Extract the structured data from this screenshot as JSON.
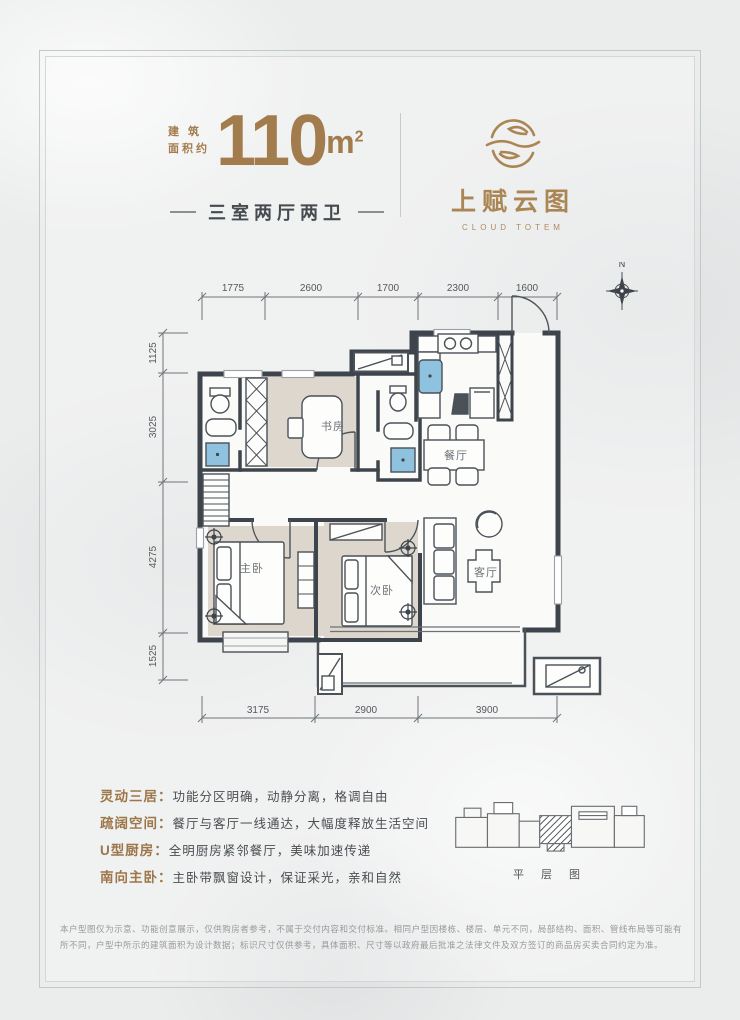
{
  "header": {
    "area_label_line1": "建 筑",
    "area_label_line2": "面积约",
    "area_value": "110",
    "area_unit_base": "m",
    "area_unit_exp": "2",
    "layout_subtitle": "三室两厅两卫"
  },
  "logo": {
    "zh": "上赋云图",
    "en": "CLOUD TOTEM"
  },
  "floorplan": {
    "compass": "N",
    "dims_top": [
      "1775",
      "2600",
      "1700",
      "2300",
      "1600"
    ],
    "dims_left": [
      "1125",
      "3025",
      "4275",
      "1525"
    ],
    "dims_bottom": [
      "3175",
      "2900",
      "3900"
    ],
    "rooms": {
      "study": "书房",
      "dining": "餐厅",
      "master": "主卧",
      "second": "次卧",
      "living": "客厅"
    }
  },
  "features": [
    {
      "label": "灵动三居：",
      "desc": "功能分区明确，动静分离，格调自由"
    },
    {
      "label": "疏阔空间：",
      "desc": "餐厅与客厅一线通达，大幅度释放生活空间"
    },
    {
      "label": "U型厨房：",
      "desc": "全明厨房紧邻餐厅，美味加速传递"
    },
    {
      "label": "南向主卧：",
      "desc": "主卧带飘窗设计，保证采光，亲和自然"
    }
  ],
  "floor_diagram": {
    "label": "平 层 图"
  },
  "disclaimer": "本户型图仅为示意、功能创意展示，仅供购房者参考，不属于交付内容和交付标准。相同户型因楼栋、楼层、单元不同，局部结构、面积、管线布局等可能有所不同，户型中所示的建筑面积为设计数据；标识尺寸仅供参考，具体面积、尺寸等以政府最后批准之法律文件及双方签订的商品房买卖合同约定为准。",
  "colors": {
    "brand": "#a37c4e",
    "wall": "#3d444b",
    "fixture_blue": "#8fc2de"
  }
}
